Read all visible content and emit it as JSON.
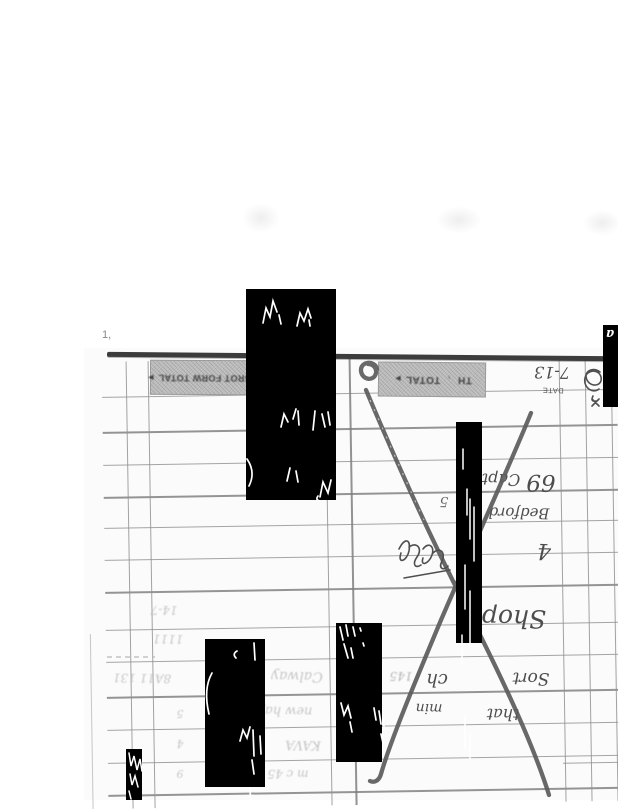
{
  "document": {
    "kind": "scanned handwritten time-book ledger page, rotated 180 degrees",
    "page_mark": "1,",
    "date_label": "DATE",
    "date_value": "7-13",
    "day_header": "TH",
    "total_label": "TOTAL",
    "total_arrow": "►",
    "separator_mark": ",",
    "brot_forw_label": "BROT FORW TOTAL",
    "brot_forw_arrow": "►"
  },
  "handwriting": {
    "note": "dark pencil handwriting, appears upside down; transcription approximate",
    "shop": "Shop",
    "sort": "Sort",
    "ch": "ch",
    "min": "min",
    "that": "that",
    "capt": "Capt",
    "sixtynine": "69",
    "bedford": "Bedford",
    "four": "4",
    "five": "5",
    "crossout": "large X crossing out the centre section"
  },
  "faint_pencil": {
    "note": "very light, mostly illegible pencil rows",
    "f1": "14-7",
    "f2": "1111",
    "f3": "8A11 131",
    "f4": "Calway",
    "f5": "new hay",
    "f6": "KAVA",
    "f7": "m c 45",
    "f9": "145",
    "d1": "5",
    "d2": "4",
    "d3": "9"
  },
  "redactions": {
    "count": 6,
    "style": "solid black rectangles with stray white handwriting traces",
    "box6_glyph": "a"
  },
  "colors": {
    "paper": "#ffffff",
    "grid_line": "#8f8f8f",
    "heavy_border": "#3c3c3c",
    "band_background": "#c6c6c6",
    "ink": "#4d4d4d",
    "faint_pencil": "#bdbdbd",
    "redaction": "#000000"
  }
}
